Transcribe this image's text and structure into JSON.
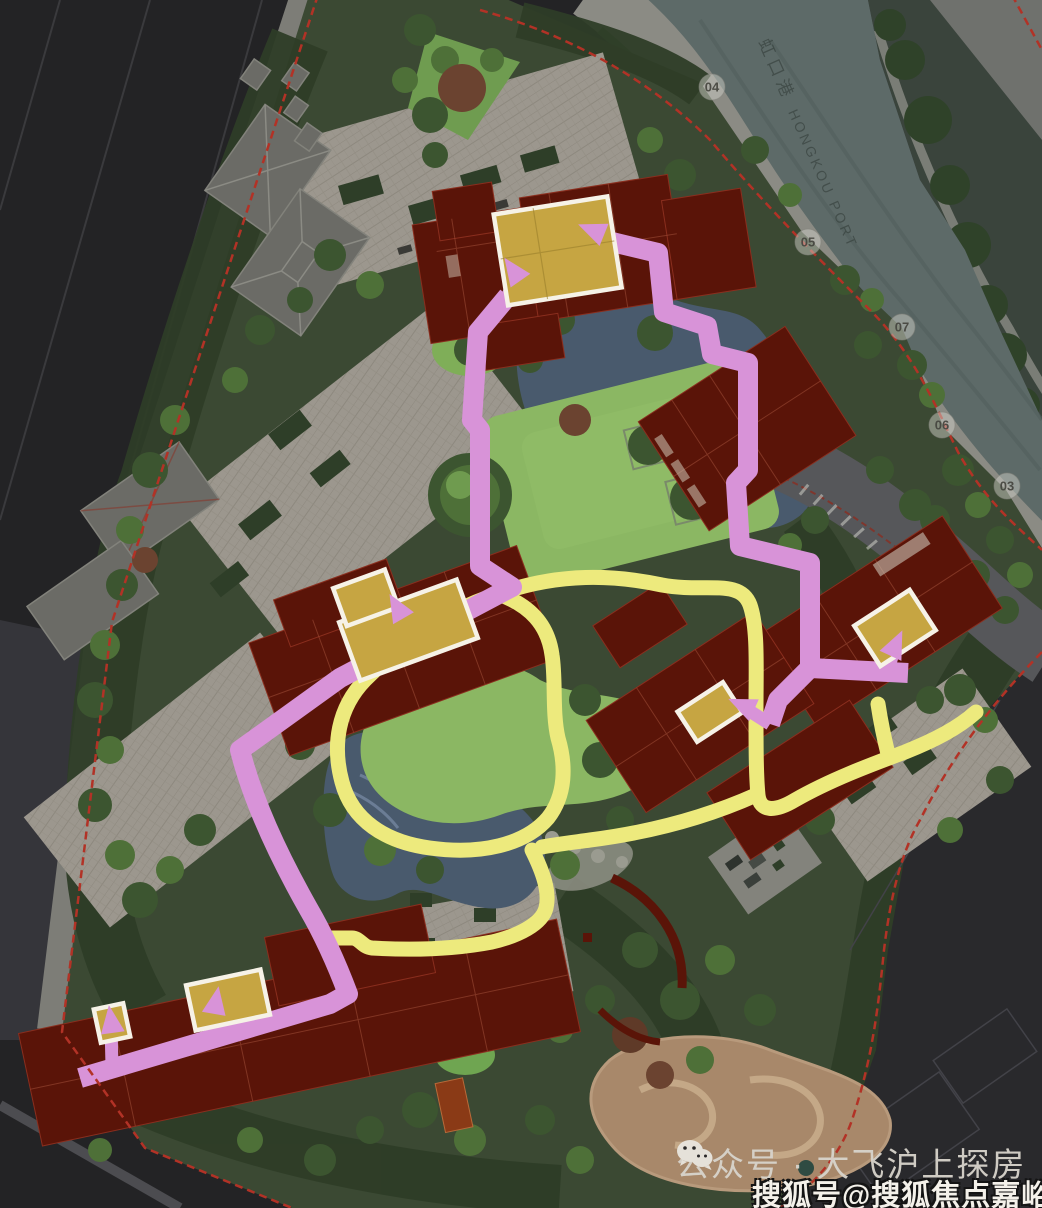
{
  "map": {
    "river": {
      "label_zh": "虹口港",
      "label_en": "HONGKOU PORT"
    },
    "boundary_markers": [
      {
        "label": "04"
      },
      {
        "label": "05"
      },
      {
        "label": "07"
      },
      {
        "label": "06"
      },
      {
        "label": "03"
      }
    ],
    "routes": {
      "home_route_color": "#d893d8",
      "garden_route_color": "#edea7d"
    },
    "colors": {
      "new_building": "#5a1408",
      "lobby_highlight": "#c6a542",
      "site_boundary": "#b23226",
      "river_water": "#5d6a68",
      "lawn": "#8bb763",
      "pond": "#495a6d"
    }
  },
  "watermark": {
    "wechat_label": "公众号 · 大飞沪上探房",
    "sohu_label": "搜狐号@搜狐焦点嘉峪关站"
  }
}
